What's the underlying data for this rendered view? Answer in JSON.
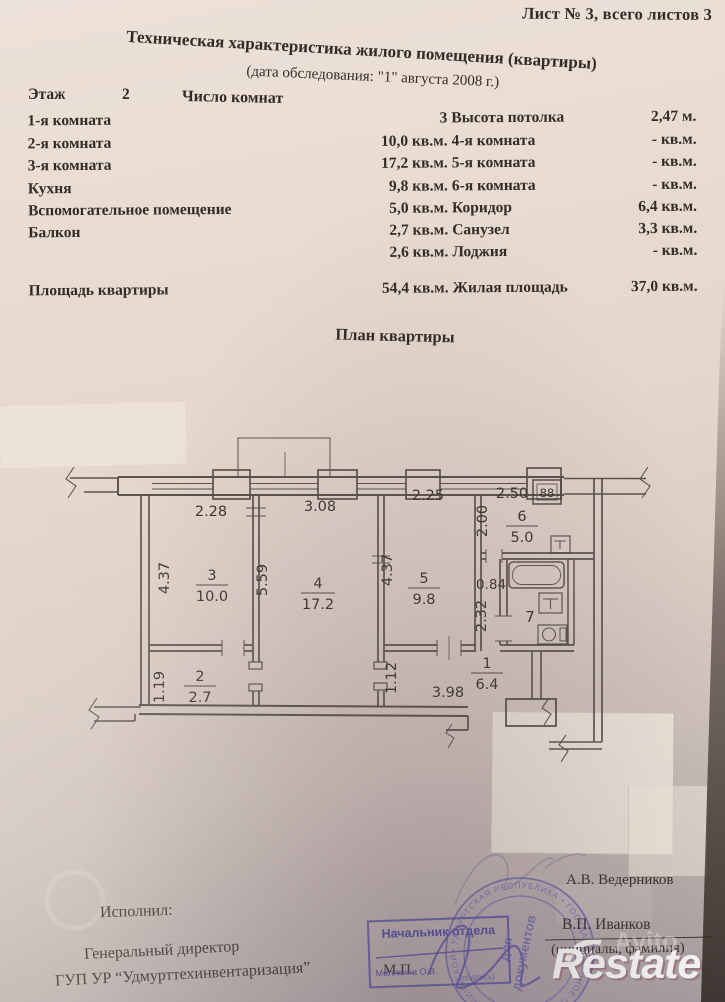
{
  "page": {
    "sheet_label": "Лист № 3, всего листов 3",
    "title": "Техническая характеристика жилого помещения (квартиры)",
    "subtitle": "(дата обследования: \"1\" августа 2008 г.)"
  },
  "info": {
    "floor_label": "Этаж",
    "floor_value": "2",
    "rooms_count_label": "Число комнат"
  },
  "table": {
    "rows": [
      {
        "label": "1-я комната",
        "value": "3",
        "right_label": "Высота потолка",
        "right_value": "2,47 м."
      },
      {
        "label": "2-я комната",
        "value": "10,0 кв.м.",
        "right_label": "4-я комната",
        "right_value": "- кв.м."
      },
      {
        "label": "3-я комната",
        "value": "17,2 кв.м.",
        "right_label": "5-я комната",
        "right_value": "- кв.м."
      },
      {
        "label": "Кухня",
        "value": "9,8 кв.м.",
        "right_label": "6-я комната",
        "right_value": "- кв.м."
      },
      {
        "label": "Вспомогательное помещение",
        "value": "5,0 кв.м.",
        "right_label": "Коридор",
        "right_value": "6,4 кв.м."
      },
      {
        "label": "Балкон",
        "value": "2,7 кв.м.",
        "right_label": "Санузел",
        "right_value": "3,3 кв.м."
      },
      {
        "label": "",
        "value": "2,6 кв.м.",
        "right_label": "Лоджия",
        "right_value": "- кв.м."
      },
      {
        "label": "Площадь квартиры",
        "value": "54,4 кв.м.",
        "right_label": "Жилая площадь",
        "right_value": "37,0 кв.м."
      }
    ]
  },
  "plan": {
    "title": "План квартиры",
    "rooms": {
      "r3": {
        "num": "3",
        "area": "10.0"
      },
      "r4": {
        "num": "4",
        "area": "17.2"
      },
      "r5": {
        "num": "5",
        "area": "9.8"
      },
      "r6": {
        "num": "6",
        "area": "5.0"
      },
      "r7": {
        "num": "7"
      },
      "r2": {
        "num": "2",
        "area": "2.7"
      },
      "r1": {
        "num": "1",
        "area": "6.4"
      }
    },
    "dims": {
      "w3": "2.28",
      "w4": "3.08",
      "w5": "2.25",
      "w6": "2.50",
      "h6": "2.00",
      "h3": "4.37",
      "h45": "5.59",
      "h5": "4.37",
      "hall_w": "0.84",
      "hall_h": "2.32",
      "h2": "1.19",
      "h1": "1.12",
      "hall_len": "3.98"
    },
    "stove_label": "88"
  },
  "footer": {
    "executed_label": "Исполнил:",
    "director_line1": "Генеральный директор",
    "director_line2": "ГУП УР “Удмурттехинвентаризация”",
    "mp": "М.П.",
    "stamp_rect": {
      "title": "Начальник отдела",
      "name": "Мелякина О.В.",
      "note": "(подпись)"
    },
    "round_stamp": {
      "ring": "• УДМУРТСКАЯ РЕСПУБЛИКА • ГОСУДАРСТВЕННОЕ ПРЕДПРИЯТИЕ ТЕХНИЧЕСКОЙ ИНВЕНТАРИЗАЦИИ",
      "center1": "для",
      "center2": "документов"
    },
    "name_top": "А.В. Ведерников",
    "name_mid": "В.П. Иванков",
    "name_note": "(инициалы, фамилия)"
  },
  "watermarks": {
    "avito": "Avito",
    "restate": "Restate"
  }
}
